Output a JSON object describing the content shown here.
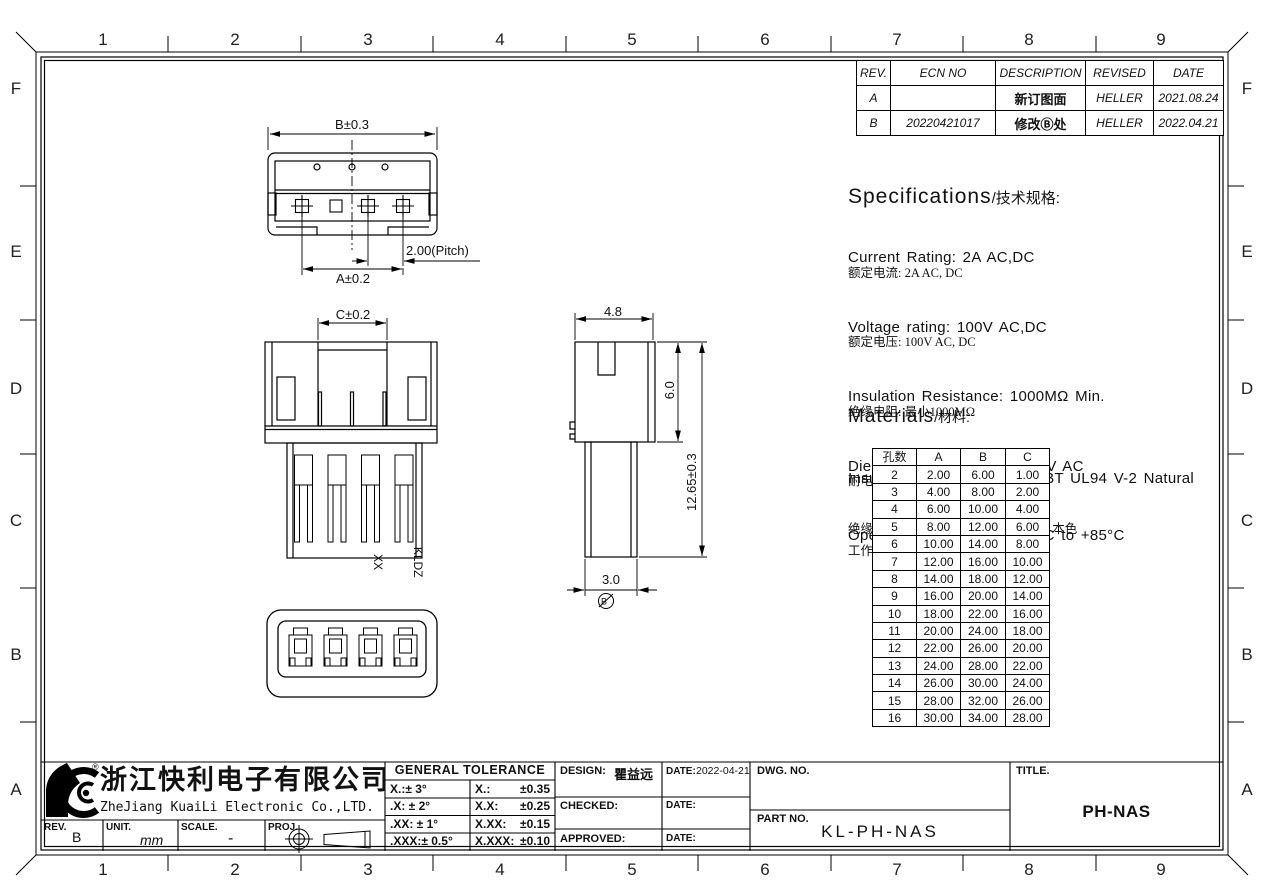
{
  "zones": {
    "cols": [
      "1",
      "2",
      "3",
      "4",
      "5",
      "6",
      "7",
      "8",
      "9"
    ],
    "rows": [
      "F",
      "E",
      "D",
      "C",
      "B",
      "A"
    ]
  },
  "revision_table": {
    "headers": [
      "REV.",
      "ECN NO",
      "DESCRIPTION",
      "REVISED",
      "DATE"
    ],
    "rows": [
      {
        "rev": "A",
        "ecn": "",
        "desc": "新订图面",
        "revised": "HELLER",
        "date": "2021.08.24"
      },
      {
        "rev": "B",
        "ecn": "20220421017",
        "desc": "修改Ⓑ处",
        "revised": "HELLER",
        "date": "2022.04.21"
      }
    ]
  },
  "specs": {
    "title_en": "Specifications",
    "title_cn": "/技术规格:",
    "items": [
      {
        "en": "Current Rating: 2A AC,DC",
        "cn": "额定电流: 2A AC, DC"
      },
      {
        "en": "Voltage rating: 100V AC,DC",
        "cn": "额定电压: 100V AC, DC"
      },
      {
        "en": "Insulation Resistance: 1000MΩ Min.",
        "cn": "绝缘电阻: 最小1000MΩ"
      },
      {
        "en": "Dielectric Withstanding: 800V AC",
        "cn": "耐电压: 800V AC"
      },
      {
        "en": "Operating Temperature:-25°C to +85°C",
        "cn": "工作温度: -25° C 到 85° C"
      }
    ]
  },
  "materials": {
    "title_en": "Materials",
    "title_cn": "/材料:",
    "en": "Insulation Material: PA or PBT UL94 V-2 Natural",
    "cn": "绝缘体塑胶材料: PA or PBT UL94 V-2 本色"
  },
  "dim_table": {
    "headers": [
      "孔数",
      "A",
      "B",
      "C"
    ],
    "rows": [
      [
        "2",
        "2.00",
        "6.00",
        "1.00"
      ],
      [
        "3",
        "4.00",
        "8.00",
        "2.00"
      ],
      [
        "4",
        "6.00",
        "10.00",
        "4.00"
      ],
      [
        "5",
        "8.00",
        "12.00",
        "6.00"
      ],
      [
        "6",
        "10.00",
        "14.00",
        "8.00"
      ],
      [
        "7",
        "12.00",
        "16.00",
        "10.00"
      ],
      [
        "8",
        "14.00",
        "18.00",
        "12.00"
      ],
      [
        "9",
        "16.00",
        "20.00",
        "14.00"
      ],
      [
        "10",
        "18.00",
        "22.00",
        "16.00"
      ],
      [
        "11",
        "20.00",
        "24.00",
        "18.00"
      ],
      [
        "12",
        "22.00",
        "26.00",
        "20.00"
      ],
      [
        "13",
        "24.00",
        "28.00",
        "22.00"
      ],
      [
        "14",
        "26.00",
        "30.00",
        "24.00"
      ],
      [
        "15",
        "28.00",
        "32.00",
        "26.00"
      ],
      [
        "16",
        "30.00",
        "34.00",
        "28.00"
      ]
    ]
  },
  "dims": {
    "b": "B±0.3",
    "pitch": "2.00(Pitch)",
    "a": "A±0.2",
    "c": "C±0.2",
    "top_width": "4.8",
    "upper_height": "6.0",
    "total_height": "12.65±0.3",
    "leg_width": "3.0",
    "balloon": "B",
    "mark_line1": "KLDZ",
    "mark_line2": "XX"
  },
  "title_block": {
    "reg_mark": "®",
    "company_cn": "浙江快利电子有限公司",
    "company_en": "ZheJiang KuaiLi Electronic Co.,LTD.",
    "rev_label": "REV.",
    "rev_value": "B",
    "unit_label": "UNIT.",
    "unit_value": "mm",
    "scale_label": "SCALE.",
    "scale_value": "-",
    "proj_label": "PROJ.",
    "tol_header": "GENERAL TOLERANCE",
    "tol_angles": [
      "X.:± 3°",
      ".X: ± 2°",
      ".XX: ± 1°",
      ".XXX:± 0.5°"
    ],
    "tol_linear": [
      {
        "l": "X.:",
        "v": "±0.35"
      },
      {
        "l": "X.X:",
        "v": "±0.25"
      },
      {
        "l": "X.XX:",
        "v": "±0.15"
      },
      {
        "l": "X.XXX:",
        "v": "±0.10"
      }
    ],
    "design_label": "DESIGN:",
    "design_value": "瞿益远",
    "date_label": "DATE:",
    "design_date": "2022-04-21",
    "checked_label": "CHECKED:",
    "approved_label": "APPROVED:",
    "dwg_label": "DWG. NO.",
    "part_label": "PART NO.",
    "part_value": "KL-PH-NAS",
    "title_label": "TITLE.",
    "title_value": "PH-NAS"
  }
}
